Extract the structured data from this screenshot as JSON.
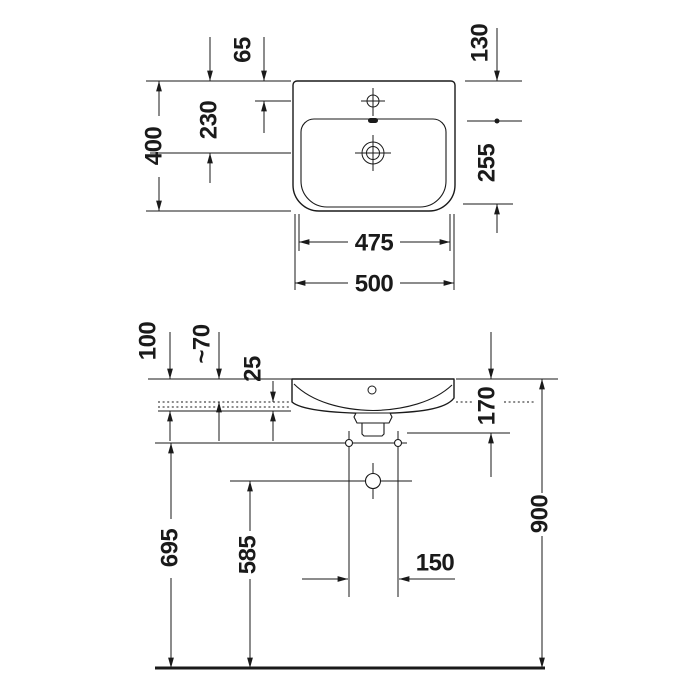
{
  "diagram": {
    "unit": "mm",
    "colors": {
      "line": "#1a1a1a",
      "background": "#ffffff"
    },
    "top_view": {
      "dims": {
        "overall_width": "500",
        "upper_width": "475",
        "overall_depth": "400",
        "rear_to_tap_hole": "65",
        "rear_to_drain": "230",
        "rear_to_bowl_front": "130",
        "bowl_front_zone": "255"
      }
    },
    "front_view": {
      "dims": {
        "rim_to_fixing_line": "100",
        "rim_above_counter": "~70",
        "counter_to_fixing": "25",
        "rim_to_overflow": "170",
        "floor_to_mounting_holes": "695",
        "floor_to_drain_center": "585",
        "drain_line_spacing": "150",
        "floor_to_rim": "900"
      }
    }
  }
}
